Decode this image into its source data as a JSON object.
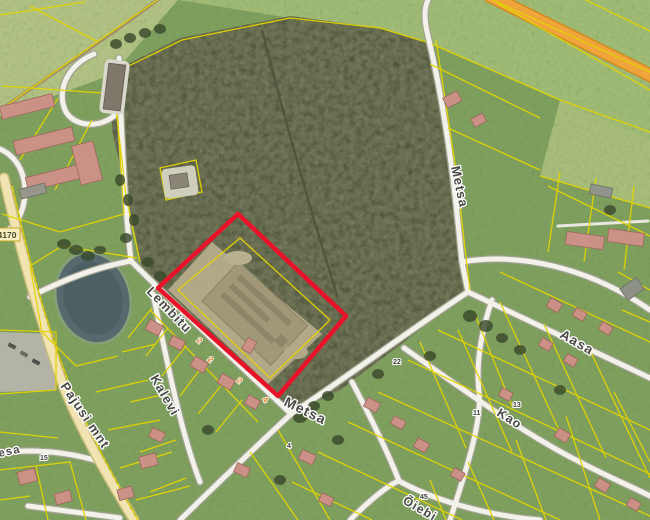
{
  "map": {
    "street_labels": [
      {
        "name": "lembitu",
        "text": "Lembitu"
      },
      {
        "name": "kalevi",
        "text": "Kalevi"
      },
      {
        "name": "metsa-north",
        "text": "Metsa"
      },
      {
        "name": "metsa-south",
        "text": "Metsa"
      },
      {
        "name": "aasa",
        "text": "Aasa"
      },
      {
        "name": "kao",
        "text": "Kao"
      },
      {
        "name": "pajusi-mnt",
        "text": "Pajusi mnt"
      },
      {
        "name": "kesa",
        "text": "Kesa"
      },
      {
        "name": "oiebi",
        "text": "Õiebi"
      }
    ],
    "road_number_badge": "4170",
    "parcel_numbers": [
      {
        "text": "22"
      },
      {
        "text": "11"
      },
      {
        "text": "13"
      },
      {
        "text": "45"
      },
      {
        "text": "4"
      },
      {
        "text": "15"
      }
    ],
    "address_marks": [
      {
        "text": "2"
      },
      {
        "text": "2"
      },
      {
        "text": "2"
      },
      {
        "text": "4"
      }
    ],
    "colors": {
      "parcel_line": "#e3d400",
      "highlight_outline": "#ea1228",
      "major_road_fill": "#f1e4b2",
      "highway_fill": "#f0a53c",
      "water": "#566a6d"
    }
  }
}
